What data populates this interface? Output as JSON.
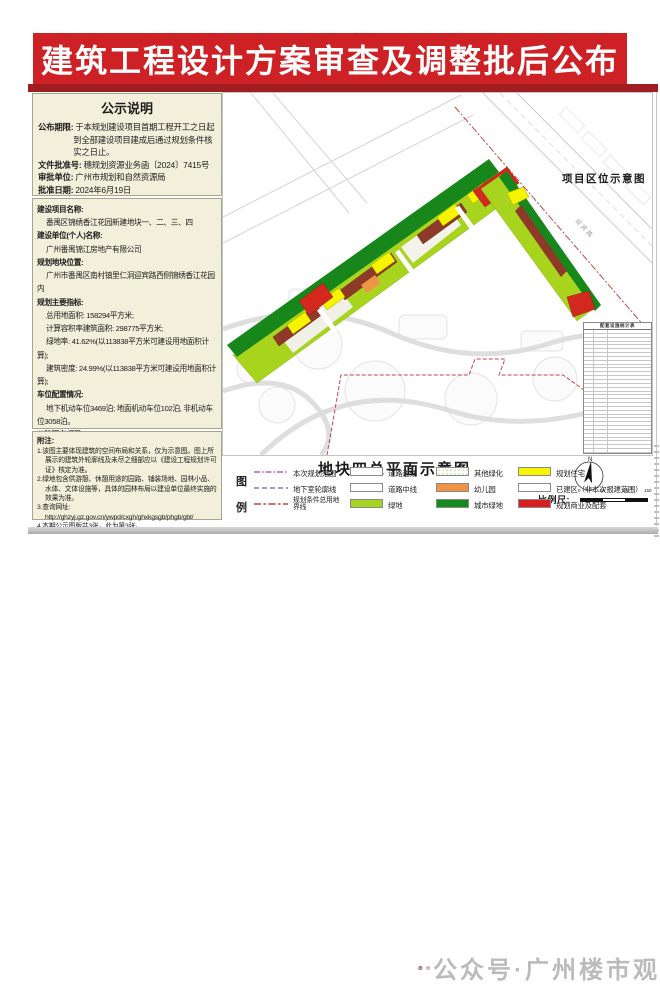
{
  "banner": {
    "title": "建筑工程设计方案审查及调整批后公布"
  },
  "notice": {
    "title": "公示说明",
    "items": [
      {
        "label": "公布期限:",
        "value": "于本规划建设项目首期工程开工之日起到全部建设项目建成后通过规划条件核实之日止。"
      },
      {
        "label": "文件批准号:",
        "value": "穗规划资源业务函〔2024〕7415号"
      },
      {
        "label": "审批单位:",
        "value": "广州市规划和自然资源局"
      },
      {
        "label": "批准日期:",
        "value": "2024年6月19日"
      }
    ]
  },
  "project": {
    "lines": [
      {
        "bold": true,
        "indent": false,
        "text": "建设项目名称:"
      },
      {
        "bold": false,
        "indent": true,
        "text": "番禺区锦绣香江花园新建地块一、二、三、四"
      },
      {
        "bold": true,
        "indent": false,
        "text": "建设单位(个人)名称:"
      },
      {
        "bold": false,
        "indent": true,
        "text": "广州番禺锦江房地产有限公司"
      },
      {
        "bold": true,
        "indent": false,
        "text": "规划地块位置:"
      },
      {
        "bold": false,
        "indent": true,
        "text": "广州市番禺区南村镇里仁洞迎宾路西侧锦绣香江花园内"
      },
      {
        "bold": true,
        "indent": false,
        "text": "规划主要指标:"
      },
      {
        "bold": false,
        "indent": true,
        "text": "总用地面积: 158294平方米;"
      },
      {
        "bold": false,
        "indent": true,
        "text": "计算容积率建筑面积: 298775平方米;"
      },
      {
        "bold": false,
        "indent": true,
        "text": "绿地率: 41.62%(以113838平方米可建设用地面积计算);"
      },
      {
        "bold": false,
        "indent": true,
        "text": "建筑密度: 24.99%(以113838平方米可建设用地面积计算);"
      },
      {
        "bold": true,
        "indent": false,
        "text": "车位配置情况:"
      },
      {
        "bold": false,
        "indent": true,
        "text": "地下机动车位3469泊; 地面机动车位102泊, 非机动车位3058泊。"
      },
      {
        "bold": true,
        "indent": false,
        "text": "公建配套项目:"
      },
      {
        "bold": false,
        "indent": true,
        "text": "详见右侧配套设施统计表。"
      }
    ]
  },
  "notes": {
    "title": "附注:",
    "lines": [
      "1.该图主要体现建筑的空间布局和关系，仅为示意图。图上所展示的建筑外轮廓线及未尽之细部应以《建设工程规划许可证》核定为准。",
      "2.绿地包含供游憩、休憩用途的园路、铺装场地、园林小品、水体、文体设施等，具体的园林布局以建设单位最终实施的效果为准。",
      "3.查询网址:",
      "http://ghzyj.gz.gov.cn/ywpd/cxgh/ghxkgsgb/phgb/gbt/",
      "4.本期公示图版共3张，此为第3张。"
    ]
  },
  "map": {
    "location_label": "项目区位示意图",
    "road_label": "迎宾路",
    "table_title": "配套设施统计表"
  },
  "legend": {
    "section_title": "地块四总平面示意图",
    "key_chars": [
      "图",
      "例"
    ],
    "line_items": [
      {
        "label": "本次规划范围",
        "color": "#bb5fb8",
        "dash": "6 2 1.5 2"
      },
      {
        "label": "地下室轮廓线",
        "color": "#6e7fc4",
        "dash": "5 3"
      },
      {
        "label": "规划条件总用地界线",
        "color": "#c94242",
        "dash": "7 2.5 2.5 2.5"
      }
    ],
    "box_items": [
      {
        "col": 2,
        "row": 1,
        "label": "道路边线",
        "fill": "#ffffff"
      },
      {
        "col": 2,
        "row": 2,
        "label": "道路中线",
        "fill": "#ffffff"
      },
      {
        "col": 2,
        "row": 3,
        "label": "绿地",
        "fill": "#a6d420"
      },
      {
        "col": 3,
        "row": 1,
        "label": "其他绿化",
        "fill": "dots"
      },
      {
        "col": 3,
        "row": 2,
        "label": "幼儿园",
        "fill": "#ef9446"
      },
      {
        "col": 3,
        "row": 3,
        "label": "城市绿地",
        "fill": "#178a1d"
      },
      {
        "col": 4,
        "row": 1,
        "label": "规划住宅",
        "fill": "#f9f400"
      },
      {
        "col": 4,
        "row": 2,
        "label": "已建区（非本次报建范围）",
        "fill": "#ffffff"
      },
      {
        "col": 4,
        "row": 3,
        "label": "规划商业及配套",
        "fill": "#d81f1f"
      }
    ],
    "scale_label": "比例尺:",
    "scale_ticks": [
      "0",
      "50",
      "100",
      "150"
    ],
    "north_label": "N"
  },
  "watermark": {
    "text": "公众号·广州楼市观"
  }
}
